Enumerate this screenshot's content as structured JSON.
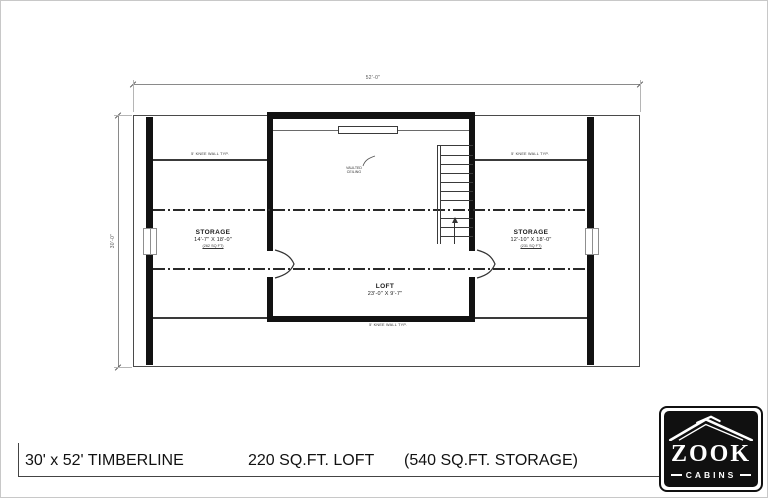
{
  "dimensions": {
    "overall_width": "52'-0\"",
    "overall_depth": "30'-0\""
  },
  "rooms": {
    "storage_left": {
      "name": "STORAGE",
      "size": "14'-7\" X 18'-0\"",
      "note": "(262 SQ FT)"
    },
    "storage_right": {
      "name": "STORAGE",
      "size": "12'-10\" X 18'-0\"",
      "note": "(231 SQ FT)"
    },
    "loft": {
      "name": "LOFT",
      "size": "23'-0\" X 9'-7\""
    }
  },
  "annotations": {
    "vaulted_line1": "VAULTED",
    "vaulted_line2": "CEILING",
    "knee_wall_left": "5' KNEE WALL TYP.",
    "knee_wall_right": "5' KNEE WALL TYP.",
    "knee_wall_bottom": "5' KNEE WALL TYP."
  },
  "footer": {
    "model": "30' x 52' TIMBERLINE",
    "loft_area": "220 SQ.FT. LOFT",
    "storage_area": "(540 SQ.FT. STORAGE)"
  },
  "logo": {
    "brand": "ZOOK",
    "subtitle": "CABINS"
  },
  "colors": {
    "wall": "#121212",
    "dimension": "#8a8a8a",
    "logo_bg": "#101010"
  }
}
